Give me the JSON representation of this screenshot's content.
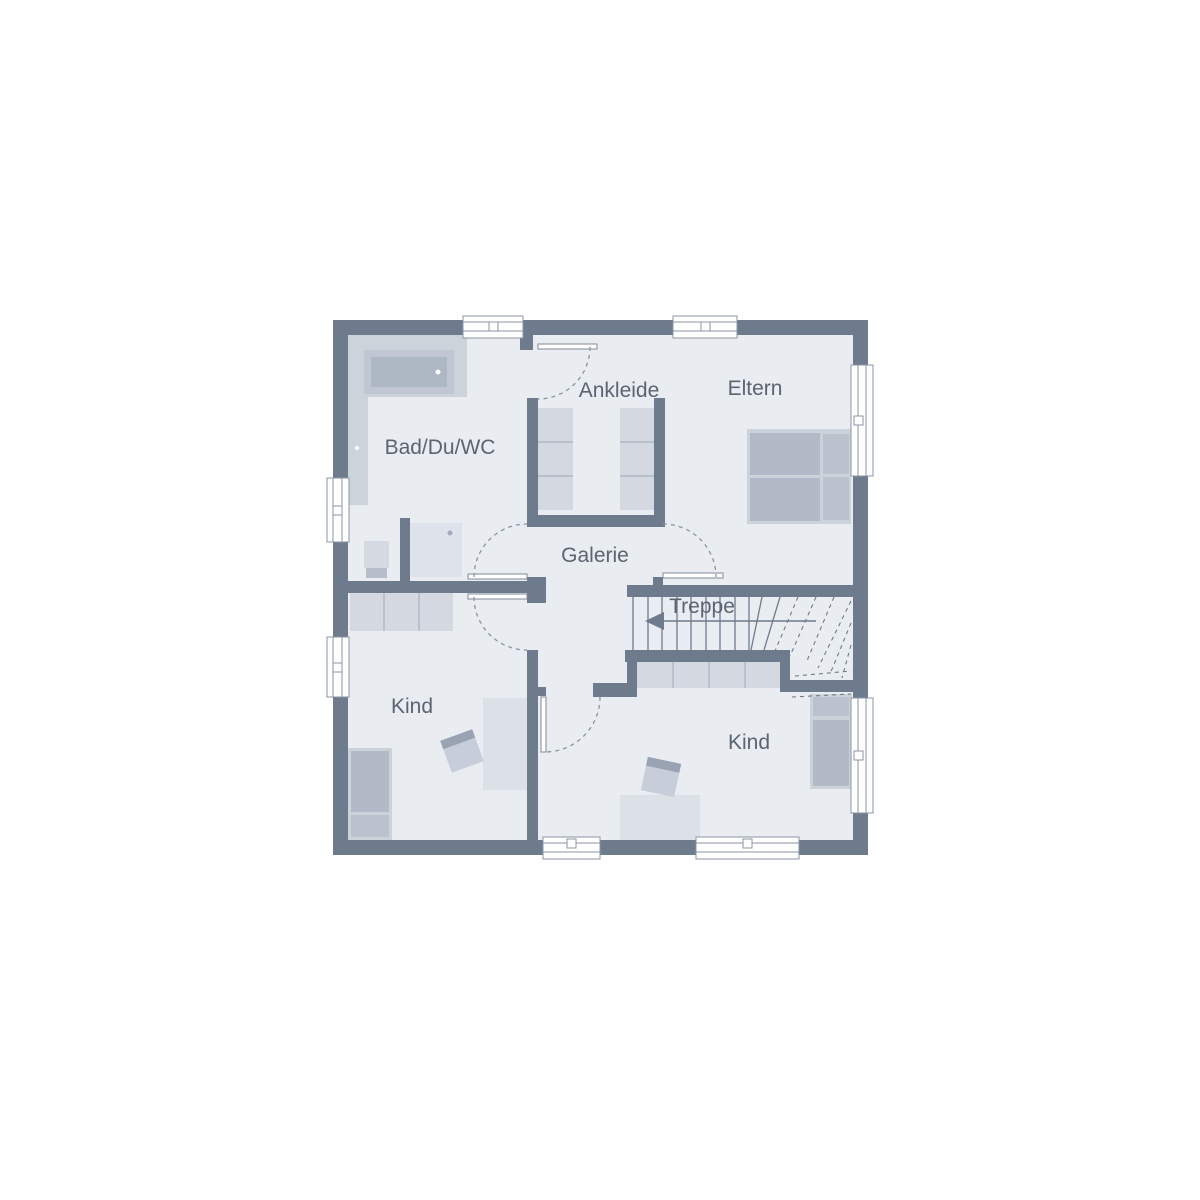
{
  "plan": {
    "type": "floorplan-upper-storey",
    "rooms": [
      {
        "id": "bad",
        "label": "Bad/Du/WC"
      },
      {
        "id": "ankleide",
        "label": "Ankleide"
      },
      {
        "id": "eltern",
        "label": "Eltern"
      },
      {
        "id": "galerie",
        "label": "Galerie"
      },
      {
        "id": "treppe",
        "label": "Treppe"
      },
      {
        "id": "kind-left",
        "label": "Kind"
      },
      {
        "id": "kind-right",
        "label": "Kind"
      }
    ],
    "colors": {
      "wall": "#6e7b8c",
      "floor": "#e9edf2",
      "furniture_frame": "#ccd2da",
      "mattress": "#b2bac7",
      "wardrobe": "#d3d8e1",
      "desk": "#dce1e8",
      "label_text": "#5b6470",
      "background": "#ffffff"
    },
    "furniture": [
      "bathtub",
      "shower",
      "toilet",
      "vanity-counter",
      "wardrobe-ankleide-left",
      "wardrobe-ankleide-right",
      "double-bed-eltern",
      "wardrobe-kind-left",
      "bed-kind-left",
      "desk-kind-left",
      "chair-kind-left",
      "closet-under-stairs",
      "bed-kind-right",
      "desk-kind-right",
      "chair-kind-right"
    ],
    "windows_count": 8,
    "doors_count": 5,
    "stair": {
      "label": "Treppe",
      "direction_arrow": "left",
      "straight_treads": 9,
      "winder_treads": "fan-right"
    }
  }
}
